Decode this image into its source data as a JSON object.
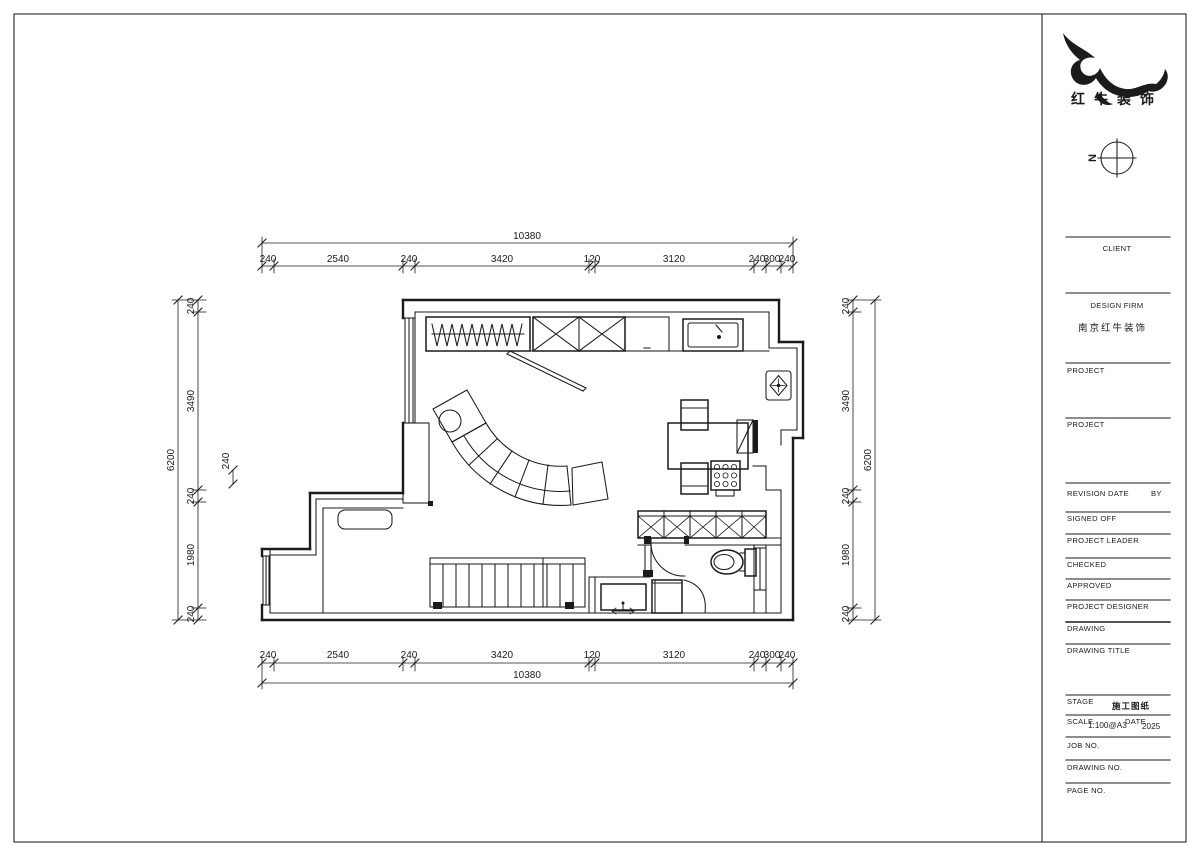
{
  "brand": {
    "logo_text": "红牛装饰",
    "compass_label": "N"
  },
  "title_block": {
    "client_label": "CLIENT",
    "design_firm_label": "DESIGN FIRM",
    "design_firm_name": "南京红牛装饰",
    "project_label_1": "PROJECT",
    "project_label_2": "PROJECT",
    "revision_label": "REVISION",
    "date_label": "DATE",
    "by_label": "BY",
    "signed_off_label": "SIGNED OFF",
    "project_leader_label": "PROJECT LEADER",
    "checked_label": "CHECKED",
    "approved_label": "APPROVED",
    "project_designer_label": "PROJECT DESIGNER",
    "drawing_label": "DRAWING",
    "drawing_title_label": "DRAWING TITLE",
    "stage_label": "STAGE",
    "stage_value": "施工图纸",
    "scale_label": "SCALE",
    "scale_value": "1:100@A3",
    "date2_label": "DATE",
    "date_value": "2025",
    "job_no_label": "JOB NO.",
    "drawing_no_label": "DRAWING NO.",
    "page_no_label": "PAGE NO."
  },
  "dimensions": {
    "top_total": "10380",
    "bottom_total": "10380",
    "left_total": "6200",
    "right_total": "6200",
    "floating_240": "240",
    "top_segments": [
      "240",
      "2540",
      "240",
      "3420",
      "120",
      "3120",
      "240",
      "300",
      "240"
    ],
    "bottom_segments": [
      "240",
      "2540",
      "240",
      "3420",
      "120",
      "3120",
      "240",
      "300",
      "240"
    ],
    "left_segments": [
      "240",
      "3490",
      "240",
      "1980",
      "240"
    ],
    "right_segments": [
      "240",
      "3490",
      "240",
      "1980",
      "240"
    ]
  }
}
